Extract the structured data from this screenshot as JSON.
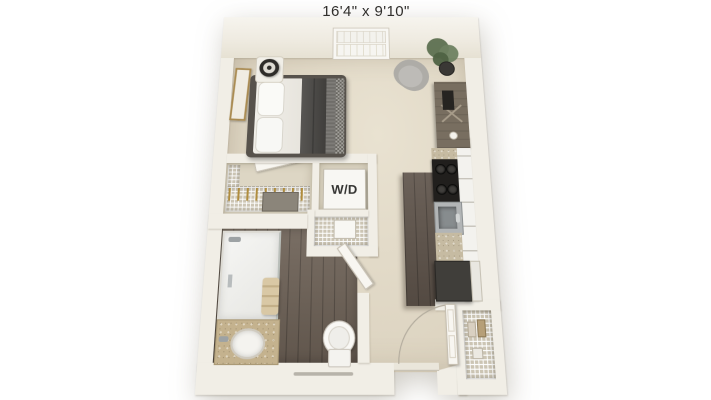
{
  "title": {
    "dimensions": "16'4\" x 9'10\""
  },
  "labels": {
    "washer_dryer": "W/D"
  },
  "colors": {
    "background": "#ffffff",
    "wall": "#f1eee6",
    "carpet": "#dcd3c0",
    "carpet_light": "#e9e2d1",
    "wood": "#6e6257",
    "fixture": "#f8f7f3",
    "counter": "#c6bba2",
    "vanity_top": "#c4b28e",
    "appliance_dark": "#211f1d",
    "fridge": "#403e3a",
    "bed_frame": "#57524c",
    "blanket": "#4b4946",
    "chair": "#bdbbb7",
    "plant": "#61734f",
    "desk": "#786e60",
    "hanger": "#b08d3e",
    "steel": "#9da2a4"
  }
}
